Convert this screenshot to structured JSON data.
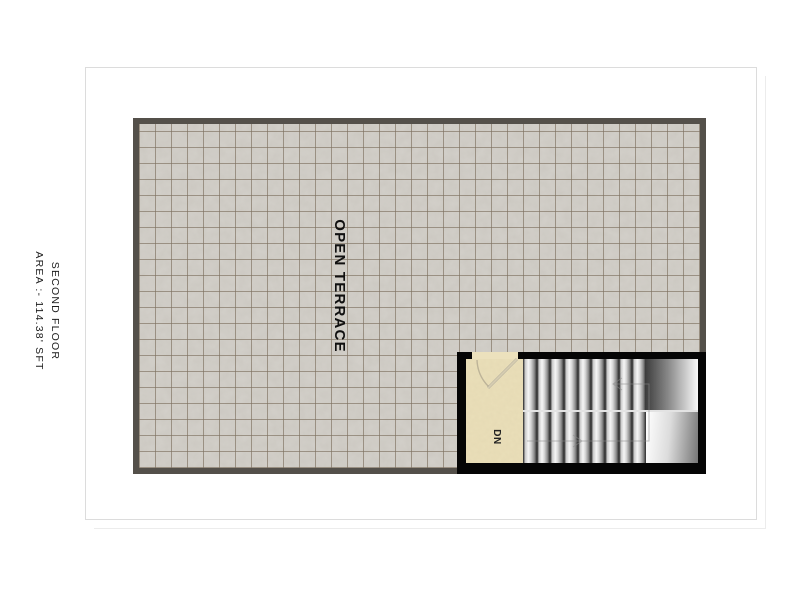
{
  "floor": {
    "title": "SECOND FLOOR",
    "area_label": "AREA :- 114.38' SFT",
    "area_value_sft": 114.38
  },
  "rooms": [
    {
      "name_label": "OPEN TERRACE",
      "surface": "tiled"
    }
  ],
  "stairs": {
    "direction_label": "DN",
    "flights": 2,
    "treads_per_flight": 9
  },
  "colors": {
    "page_background": "#ffffff",
    "paper_border": "#dcdcdc",
    "plan_border": "#54504a",
    "tile_fill": "#d3d0ca",
    "tile_grid_line": "#7d705f",
    "stair_border": "#050505",
    "landing_fill": "#eadfb9",
    "label_text": "#1c1c1c"
  }
}
